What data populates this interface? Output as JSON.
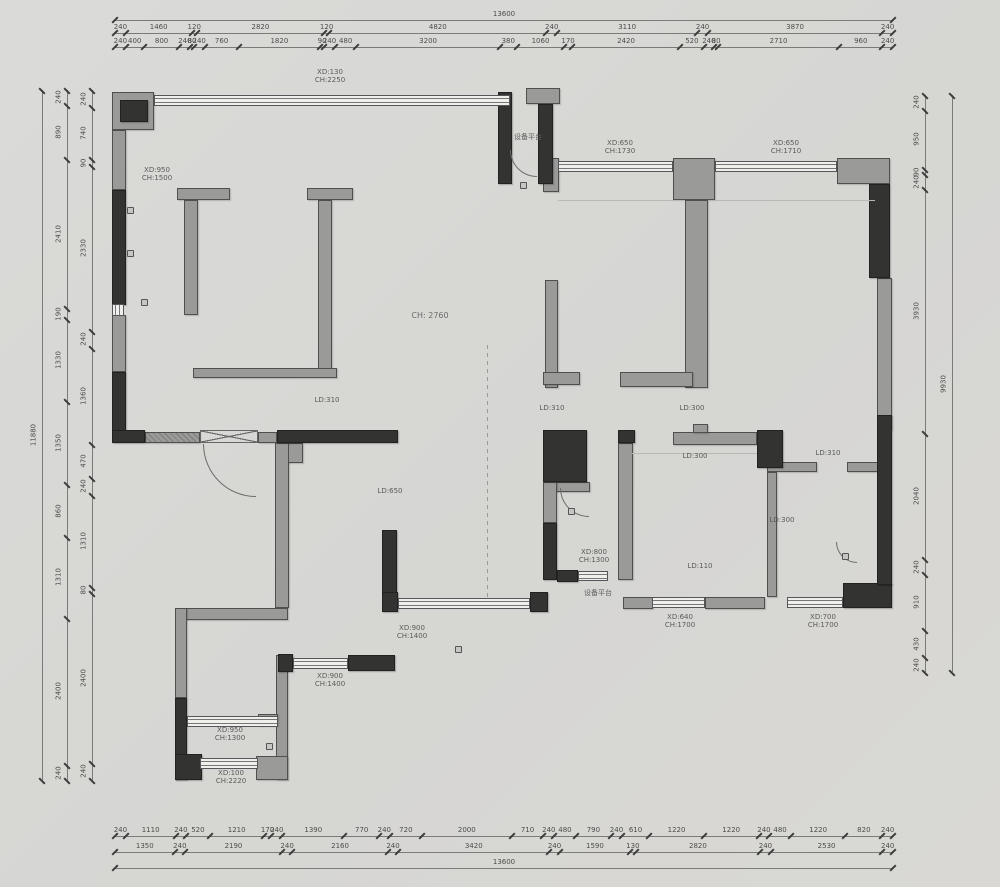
{
  "meta": {
    "drawing_type": "apartment floor plan (original structure survey)"
  },
  "colors": {
    "background": "#d8d7d4",
    "wall_gray": "#9a9a98",
    "wall_dark": "#333331",
    "window_band": "#efefec",
    "dim_text": "#4c4c4a"
  },
  "dimensions": {
    "top": {
      "total": "13600",
      "tier2": [
        "240",
        "1460",
        "120",
        "2820",
        "120",
        "4820",
        "240",
        "3110",
        "240",
        "3870",
        "240"
      ],
      "tier1": [
        "240",
        "400",
        "800",
        "240",
        "80",
        "240",
        "760",
        "1820",
        "90",
        "240",
        "480",
        "3200",
        "380",
        "1060",
        "170",
        "2420",
        "520",
        "240",
        "80",
        "2710",
        "960",
        "240"
      ]
    },
    "bottom": {
      "total": "13600",
      "tier1": [
        "240",
        "1110",
        "240",
        "520",
        "1210",
        "170",
        "240",
        "1390",
        "770",
        "240",
        "720",
        "2000",
        "710",
        "240",
        "480",
        "790",
        "240",
        "610",
        "1220",
        "1220",
        "240",
        "480",
        "1220",
        "820",
        "240"
      ],
      "tier2": [
        "1350",
        "240",
        "2190",
        "240",
        "2160",
        "240",
        "3420",
        "240",
        "1590",
        "130",
        "2820",
        "240",
        "2530",
        "240"
      ]
    },
    "left": {
      "total": "11880",
      "tier2": [
        "240",
        "890",
        "2410",
        "190",
        "1330",
        "1350",
        "860",
        "1310",
        "2400",
        "240"
      ],
      "tier1": [
        "240",
        "740",
        "90",
        "2330",
        "240",
        "1360",
        "470",
        "240",
        "1310",
        "80",
        "2400",
        "240"
      ]
    },
    "right": {
      "total": "9930",
      "tier1": [
        "240",
        "950",
        "90",
        "240",
        "3930",
        "2040",
        "240",
        "910",
        "430",
        "240"
      ]
    }
  },
  "annotations": {
    "top_window": "XD:130\nCH:2250",
    "left_room_window": "XD:950\nCH:1500",
    "platform_top": "设备平台",
    "mid_window_1": "XD:650\nCH:1730",
    "mid_window_2": "XD:650\nCH:1710",
    "living_height": "CH: 2760",
    "beam_1": "LD:310",
    "beam_2": "LD:310",
    "beam_3": "LD:300",
    "beam_4": "LD:310",
    "beam_5": "LD:300",
    "beam_6": "LD:300",
    "beam_7": "LD:650",
    "beam_8": "LD:110",
    "bath_window": "XD:800\nCH:1300",
    "platform_bottom": "设备平台",
    "bottom_window_1": "XD:640\nCH:1700",
    "bottom_window_2": "XD:700\nCH:1700",
    "bottom_window_3": "XD:900\nCH:1400",
    "bottom_window_4": "XD:900\nCH:1400",
    "small_room_window_1": "XD:950\nCH:1300",
    "small_room_window_2": "XD:100\nCH:2220"
  }
}
